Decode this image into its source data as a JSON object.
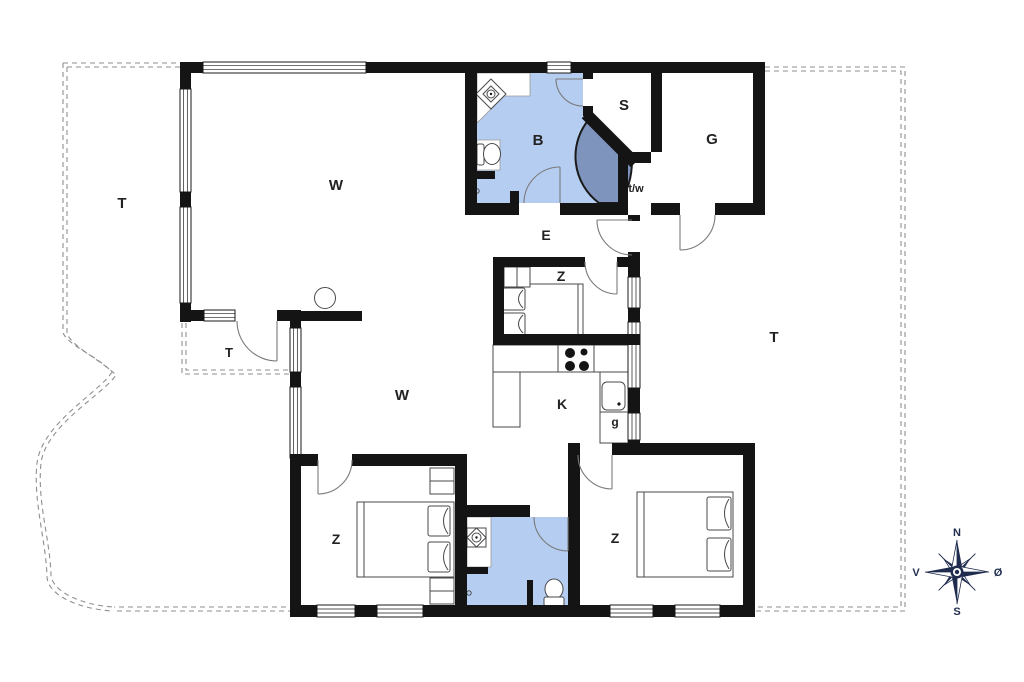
{
  "meta": {
    "width": 1024,
    "height": 682,
    "description": "House floor plan with terraces and compass rose"
  },
  "colors": {
    "wall": "#141414",
    "bath_fill": "#b5cdf0",
    "corner_shower_fill": "#7e94bc",
    "boundary_dash": "#8f8f8f",
    "fixture_stroke": "#4a4a4a",
    "door_stroke": "#7a7a7a",
    "window_stroke": "#1a1a1a",
    "label": "#222222",
    "compass": "#1f2c4e"
  },
  "rooms": {
    "labels": [
      {
        "id": "terrace-west",
        "text": "T",
        "x": 122,
        "y": 208,
        "size": 15
      },
      {
        "id": "living-upper",
        "text": "W",
        "x": 336,
        "y": 190,
        "size": 15
      },
      {
        "id": "bath-top",
        "text": "B",
        "x": 538,
        "y": 145,
        "size": 15
      },
      {
        "id": "sauna",
        "text": "S",
        "x": 624,
        "y": 110,
        "size": 15
      },
      {
        "id": "garage",
        "text": "G",
        "x": 712,
        "y": 144,
        "size": 15
      },
      {
        "id": "utility",
        "text": "t/w",
        "x": 636,
        "y": 192,
        "size": 11
      },
      {
        "id": "entry",
        "text": "E",
        "x": 546,
        "y": 240,
        "size": 14
      },
      {
        "id": "bedroom-mid",
        "text": "Z",
        "x": 561,
        "y": 281,
        "size": 14
      },
      {
        "id": "terrace-small",
        "text": "T",
        "x": 229,
        "y": 357,
        "size": 13
      },
      {
        "id": "terrace-east",
        "text": "T",
        "x": 774,
        "y": 342,
        "size": 15
      },
      {
        "id": "living-lower",
        "text": "W",
        "x": 402,
        "y": 400,
        "size": 15
      },
      {
        "id": "kitchen",
        "text": "K",
        "x": 562,
        "y": 409,
        "size": 14
      },
      {
        "id": "cabinet",
        "text": "g",
        "x": 615,
        "y": 426,
        "size": 12
      },
      {
        "id": "bedroom-sw",
        "text": "Z",
        "x": 336,
        "y": 544,
        "size": 14
      },
      {
        "id": "bedroom-east",
        "text": "Z",
        "x": 615,
        "y": 543,
        "size": 14
      }
    ]
  },
  "compass": {
    "cx": 957,
    "cy": 572,
    "main_point_length": 32,
    "main_point_halfwidth": 6,
    "diag_point_length": 19,
    "diag_point_halfwidth": 4,
    "cross_line_length": 26,
    "letters": [
      {
        "id": "north",
        "text": "N",
        "x": 957,
        "y": 536
      },
      {
        "id": "south",
        "text": "S",
        "x": 957,
        "y": 615
      },
      {
        "id": "west",
        "text": "V",
        "x": 916,
        "y": 576
      },
      {
        "id": "east",
        "text": "Ø",
        "x": 998,
        "y": 576
      }
    ]
  },
  "geometry": {
    "boundaries": [
      "M63,63 H180 M765,67 H905 V611 H113 M63,63 V333 C70,347 96,355 112,372 C100,392 42,423 37,463 C33,502 46,540 47,577 C48,595 78,609 113,611",
      "M67,67 H180 M765,71 H901 V607 H114 M67,67 V334 C73,347 99,359 116,375 C104,394 46,425 41,463 C37,502 50,539 51,575 C52,591 80,605 114,607",
      "M182,323 V374 H290 M186,323 V370 H290"
    ],
    "blue_areas": [
      "M477,73 L583,73 L583,108 L621,146 L621,203 L477,203 Z",
      "M467,517 L568,517 L568,605 L467,605 Z"
    ],
    "niches": [
      "M477,73 L530,73 L530,96 L504,96 L477,123 Z",
      "M477,140 L500,140 L500,170 L477,170 Z",
      "M467,517 L491,517 L491,567 L467,567 Z"
    ],
    "corner_shower": "M632,160 L590,118 A58,58 0 0 0 599,203 L619,203 Q632,186 632,160 Z",
    "walls": [
      [
        180,
        62,
        23,
        11
      ],
      [
        366,
        62,
        181,
        11
      ],
      [
        571,
        62,
        194,
        11
      ],
      [
        180,
        62,
        11,
        27
      ],
      [
        180,
        192,
        11,
        15
      ],
      [
        180,
        303,
        11,
        19
      ],
      [
        180,
        310,
        24,
        11
      ],
      [
        277,
        310,
        24,
        11
      ],
      [
        300,
        311,
        62,
        10
      ],
      [
        290,
        310,
        11,
        18
      ],
      [
        290,
        372,
        11,
        15
      ],
      [
        290,
        458,
        11,
        159
      ],
      [
        290,
        605,
        27,
        12
      ],
      [
        355,
        605,
        22,
        12
      ],
      [
        423,
        605,
        187,
        12
      ],
      [
        653,
        605,
        22,
        12
      ],
      [
        720,
        605,
        35,
        12
      ],
      [
        743,
        443,
        12,
        174
      ],
      [
        568,
        443,
        12,
        174
      ],
      [
        612,
        443,
        143,
        12
      ],
      [
        628,
        215,
        12,
        6
      ],
      [
        628,
        252,
        12,
        25
      ],
      [
        628,
        308,
        12,
        14
      ],
      [
        628,
        388,
        12,
        25
      ],
      [
        628,
        440,
        12,
        15
      ],
      [
        465,
        203,
        48,
        12
      ],
      [
        510,
        191,
        9,
        24
      ],
      [
        560,
        203,
        58,
        12
      ],
      [
        618,
        152,
        10,
        63
      ],
      [
        618,
        152,
        33,
        11
      ],
      [
        651,
        203,
        29,
        12
      ],
      [
        715,
        203,
        50,
        12
      ],
      [
        651,
        73,
        11,
        79
      ],
      [
        753,
        73,
        12,
        130
      ],
      [
        465,
        73,
        12,
        130
      ],
      [
        583,
        73,
        10,
        6
      ],
      [
        583,
        106,
        10,
        10
      ],
      [
        493,
        257,
        92,
        10
      ],
      [
        617,
        257,
        11,
        10
      ],
      [
        493,
        257,
        11,
        88
      ],
      [
        493,
        334,
        147,
        11
      ],
      [
        290,
        454,
        28,
        12
      ],
      [
        352,
        454,
        103,
        12
      ],
      [
        455,
        454,
        12,
        163
      ],
      [
        467,
        505,
        63,
        12
      ],
      [
        477,
        171,
        18,
        8
      ],
      [
        467,
        567,
        21,
        7
      ],
      [
        527,
        580,
        6,
        26
      ]
    ],
    "diagonal_wall": "M586,114 L635,163",
    "windows": [
      [
        203,
        62,
        163,
        11
      ],
      [
        547,
        62,
        24,
        11
      ],
      [
        180,
        89,
        11,
        103
      ],
      [
        180,
        207,
        11,
        96
      ],
      [
        204,
        310,
        31,
        11
      ],
      [
        290,
        328,
        11,
        44
      ],
      [
        290,
        387,
        11,
        71
      ],
      [
        317,
        605,
        38,
        12
      ],
      [
        377,
        605,
        46,
        12
      ],
      [
        610,
        605,
        43,
        12
      ],
      [
        675,
        605,
        45,
        12
      ],
      [
        628,
        277,
        12,
        31
      ],
      [
        628,
        322,
        12,
        66
      ],
      [
        628,
        413,
        12,
        27
      ]
    ],
    "doors": [
      {
        "id": "living-to-terrace",
        "leaf": "M277,321 L277,361",
        "arc": "M237,321 A40,40 0 0 0 277,361"
      },
      {
        "id": "bath-to-sauna",
        "leaf": "M583,79 L556,79",
        "arc": "M556,79 A27,27 0 0 0 583,106"
      },
      {
        "id": "bath-top-door",
        "leaf": "M560,203 L560,167",
        "arc": "M524,203 A36,36 0 0 1 560,167"
      },
      {
        "id": "garage-door",
        "leaf": "M680,215 L680,250",
        "arc": "M680,250 A35,35 0 0 0 715,215"
      },
      {
        "id": "entry-to-bedroom",
        "leaf": "M617,262 L617,294",
        "arc": "M585,262 A32,32 0 0 0 617,294"
      },
      {
        "id": "main-entrance",
        "leaf": "M632,220 L597,220",
        "arc": "M597,220 A35,35 0 0 0 632,255"
      },
      {
        "id": "bedroom-sw-door",
        "leaf": "M318,460 L318,494",
        "arc": "M318,494 A34,34 0 0 0 352,460"
      },
      {
        "id": "bedroom-east-door",
        "leaf": "M612,455 L612,489",
        "arc": "M578,455 A34,34 0 0 0 612,489"
      },
      {
        "id": "bath-bottom-door",
        "leaf": "M568,517 L568,551",
        "arc": "M534,517 A34,34 0 0 0 568,551"
      }
    ],
    "fixtures": [
      {
        "t": "rect",
        "n": "kitchen-counter-top",
        "x": 493,
        "y": 345,
        "w": 135,
        "h": 27
      },
      {
        "t": "rect",
        "n": "kitchen-counter-right",
        "x": 600,
        "y": 372,
        "w": 28,
        "h": 40
      },
      {
        "t": "rect",
        "n": "kitchen-cabinet-g",
        "x": 600,
        "y": 412,
        "w": 28,
        "h": 31
      },
      {
        "t": "rect",
        "n": "kitchen-counter-left",
        "x": 493,
        "y": 372,
        "w": 27,
        "h": 55
      },
      {
        "t": "rect",
        "n": "stove",
        "x": 558,
        "y": 345,
        "w": 36,
        "h": 27
      },
      {
        "t": "circle",
        "n": "burner",
        "cx": 570,
        "cy": 353,
        "r": 5,
        "fill": "dark"
      },
      {
        "t": "circle",
        "n": "burner",
        "cx": 584,
        "cy": 352,
        "r": 3.5,
        "fill": "dark"
      },
      {
        "t": "circle",
        "n": "burner",
        "cx": 570,
        "cy": 366,
        "r": 5,
        "fill": "dark"
      },
      {
        "t": "circle",
        "n": "burner",
        "cx": 584,
        "cy": 366,
        "r": 5,
        "fill": "dark"
      },
      {
        "t": "rect",
        "n": "sink",
        "x": 602,
        "y": 382,
        "w": 23,
        "h": 28,
        "rx": 5
      },
      {
        "t": "circle",
        "n": "sink-drain",
        "cx": 619,
        "cy": 404,
        "r": 1.6,
        "fill": "dark"
      },
      {
        "t": "circle",
        "n": "wood-stove",
        "cx": 325,
        "cy": 298,
        "r": 10.5
      },
      {
        "t": "rect",
        "n": "bed-mid",
        "x": 500,
        "y": 284,
        "w": 83,
        "h": 53
      },
      {
        "t": "path",
        "n": "bed-mid-footline",
        "d": "M578,284 L578,337",
        "fill": "none"
      },
      {
        "t": "rect",
        "n": "pillow",
        "x": 503,
        "y": 288,
        "w": 22,
        "h": 22,
        "rx": 2
      },
      {
        "t": "rect",
        "n": "pillow",
        "x": 503,
        "y": 313,
        "w": 22,
        "h": 22,
        "rx": 2
      },
      {
        "t": "path",
        "n": "pillow-curve",
        "d": "M523,290 Q514,299 523,308",
        "fill": "none"
      },
      {
        "t": "path",
        "n": "pillow-curve",
        "d": "M523,315 Q514,324 523,333",
        "fill": "none"
      },
      {
        "t": "rect",
        "n": "bed-sw",
        "x": 357,
        "y": 502,
        "w": 97,
        "h": 75
      },
      {
        "t": "path",
        "n": "bed-sw-footline",
        "d": "M364,502 L364,577",
        "fill": "none"
      },
      {
        "t": "rect",
        "n": "pillow",
        "x": 428,
        "y": 506,
        "w": 22,
        "h": 30,
        "rx": 2
      },
      {
        "t": "rect",
        "n": "pillow",
        "x": 428,
        "y": 542,
        "w": 22,
        "h": 30,
        "rx": 2
      },
      {
        "t": "path",
        "n": "pillow-curve",
        "d": "M448,508 Q439,521 448,534",
        "fill": "none"
      },
      {
        "t": "path",
        "n": "pillow-curve",
        "d": "M448,544 Q439,557 448,570",
        "fill": "none"
      },
      {
        "t": "rect",
        "n": "bed-east",
        "x": 637,
        "y": 492,
        "w": 96,
        "h": 85
      },
      {
        "t": "path",
        "n": "bed-east-footline",
        "d": "M644,492 L644,577",
        "fill": "none"
      },
      {
        "t": "rect",
        "n": "pillow",
        "x": 707,
        "y": 497,
        "w": 24,
        "h": 33,
        "rx": 2
      },
      {
        "t": "rect",
        "n": "pillow",
        "x": 707,
        "y": 538,
        "w": 24,
        "h": 33,
        "rx": 2
      },
      {
        "t": "path",
        "n": "pillow-curve",
        "d": "M729,499 Q720,513 729,528",
        "fill": "none"
      },
      {
        "t": "path",
        "n": "pillow-curve",
        "d": "M729,540 Q720,554 729,569",
        "fill": "none"
      },
      {
        "t": "rect",
        "n": "wardrobe",
        "x": 430,
        "y": 468,
        "w": 24,
        "h": 26
      },
      {
        "t": "rect",
        "n": "wardrobe",
        "x": 430,
        "y": 578,
        "w": 24,
        "h": 26
      },
      {
        "t": "rect",
        "n": "wardrobe",
        "x": 504,
        "y": 267,
        "w": 26,
        "h": 20
      },
      {
        "t": "path",
        "n": "wardrobe-divider",
        "d": "M430,481 L454,481",
        "fill": "none"
      },
      {
        "t": "path",
        "n": "wardrobe-divider",
        "d": "M430,591 L454,591",
        "fill": "none"
      },
      {
        "t": "path",
        "n": "wardrobe-divider",
        "d": "M517,267 L517,287",
        "fill": "none"
      },
      {
        "t": "rect",
        "n": "toilet-top-tank",
        "x": 477,
        "y": 144,
        "w": 7,
        "h": 21,
        "rx": 2
      },
      {
        "t": "ellipse",
        "n": "toilet-top-bowl",
        "cx": 492,
        "cy": 154,
        "rx": 8.5,
        "ry": 10.5
      },
      {
        "t": "ellipse",
        "n": "toilet-bottom-bowl",
        "cx": 554,
        "cy": 589,
        "rx": 9,
        "ry": 10
      },
      {
        "t": "rect",
        "n": "toilet-bottom-tank",
        "x": 544,
        "y": 597,
        "w": 20,
        "h": 9,
        "rx": 2
      },
      {
        "t": "path",
        "n": "shower-top-diamond",
        "d": "M491,79 L506,94 L491,109 L476,94 Z"
      },
      {
        "t": "path",
        "n": "shower-top-inner",
        "d": "M491,86 L499,94 L491,102 L483,94 Z",
        "fill": "none"
      },
      {
        "t": "circle",
        "n": "shower-top-drain",
        "cx": 491,
        "cy": 94,
        "r": 4
      },
      {
        "t": "circle",
        "n": "shower-top-dot",
        "cx": 491,
        "cy": 94,
        "r": 1.2,
        "fill": "dark"
      },
      {
        "t": "rect",
        "n": "shower-bottom",
        "x": 467,
        "y": 528,
        "w": 19,
        "h": 19
      },
      {
        "t": "path",
        "n": "shower-bottom-diamond",
        "d": "M476.5,528 L486,537.5 L476.5,547 L467,537.5 Z",
        "fill": "none"
      },
      {
        "t": "circle",
        "n": "shower-bottom-drain",
        "cx": 476.5,
        "cy": 537.5,
        "r": 4.5
      },
      {
        "t": "circle",
        "n": "shower-bottom-dot",
        "cx": 476.5,
        "cy": 537.5,
        "r": 1.2,
        "fill": "dark"
      },
      {
        "t": "circle",
        "n": "floor-drain",
        "cx": 477,
        "cy": 191,
        "r": 2.2,
        "fill": "none"
      },
      {
        "t": "circle",
        "n": "floor-drain",
        "cx": 469,
        "cy": 593,
        "r": 2.2,
        "fill": "none"
      }
    ]
  }
}
